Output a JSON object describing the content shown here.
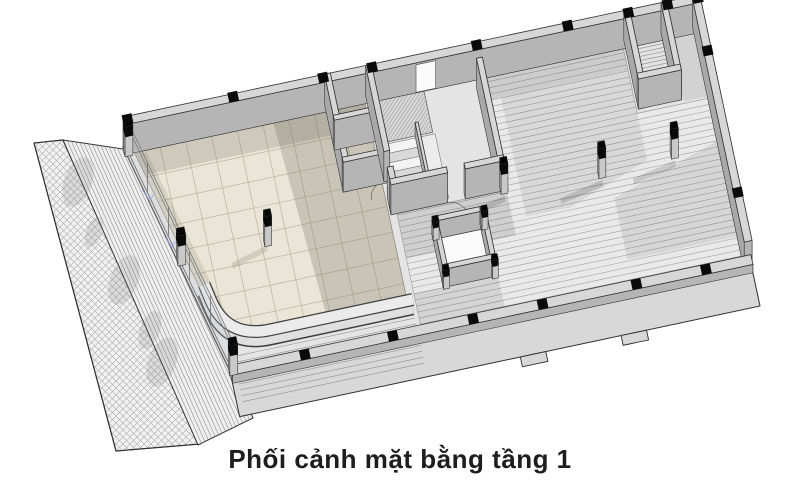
{
  "caption": {
    "text": "Phối cảnh mặt bằng tầng 1",
    "color": "#1d1d1d"
  },
  "colors": {
    "background": "#ffffff",
    "outline": "#2f2f2f",
    "slab": "#e4e4e4",
    "apron": "#d8d8d8",
    "wall_top": "#d7d7d7",
    "wall_face": "#b5b5b5",
    "wall_face_dark": "#a9a9a9",
    "wall_face_light": "#cccccc",
    "column_cap": "#0a0a0a",
    "column_shaft": "#c9c9c9",
    "tile_light": "#eae5d6",
    "tile_line": "#b3ac99",
    "tile_shadow": "#6e6859",
    "hall_base": "#e9e9e9",
    "hall_stripe": "#9b9b9b",
    "stair_light": "#f4f4f4",
    "stair_dark": "#d9d9d9",
    "hatch_line": "#909090",
    "site_line": "#a8a8a8",
    "fence_fill": "#ffffff",
    "glass_line": "#707070",
    "blue_mark": "#8fa3e8",
    "white_floor": "#fbfbfb"
  },
  "view": {
    "origin": [
      123,
      147
    ],
    "rotation": -12,
    "extrusion": [
      6.2,
      -29.3
    ]
  },
  "site": {
    "sidewalk": {
      "points": [
        [
          34,
          143
        ],
        [
          63,
          140
        ],
        [
          200,
          444
        ],
        [
          116,
          451
        ]
      ]
    },
    "ramp_strip": {
      "points": [
        [
          63,
          140
        ],
        [
          130,
          150
        ],
        [
          253,
          418
        ],
        [
          198,
          445
        ]
      ],
      "stripes": 16
    },
    "shadow_blobs": [
      [
        78,
        182,
        14,
        26
      ],
      [
        94,
        232,
        8,
        16
      ],
      [
        124,
        280,
        14,
        26
      ],
      [
        150,
        330,
        10,
        20
      ],
      [
        162,
        362,
        14,
        26
      ]
    ],
    "fence": {
      "main": [
        [
          660,
          4
        ],
        [
          688,
          1
        ],
        [
          748,
          299
        ],
        [
          720,
          311
        ]
      ],
      "notch": [
        [
          650,
          9
        ],
        [
          661,
          7
        ],
        [
          666,
          30
        ],
        [
          655,
          32
        ]
      ]
    }
  },
  "building": {
    "slab_pts": [
      [
        0,
        0
      ],
      [
        590,
        0
      ],
      [
        590,
        250
      ],
      [
        60,
        250
      ]
    ],
    "apron": {
      "x": 58,
      "y": 244,
      "w": 532,
      "h": 44,
      "notches": [
        [
          345,
          288,
          26,
          10
        ],
        [
          448,
          288,
          26,
          10
        ]
      ],
      "step_lines": {
        "x1": 64,
        "x2": 250,
        "ys": [
          228,
          234,
          240,
          256,
          262,
          268,
          274
        ]
      }
    },
    "hall": {
      "poly": [
        [
          368,
          8
        ],
        [
          510,
          8
        ],
        [
          510,
          74
        ],
        [
          582,
          74
        ],
        [
          582,
          242
        ],
        [
          254,
          242
        ],
        [
          254,
          122
        ],
        [
          368,
          122
        ]
      ],
      "stripe_step": 6.2,
      "shadows": [
        {
          "pts": [
            [
              368,
              8
            ],
            [
              510,
              8
            ],
            [
              510,
              30
            ],
            [
              368,
              30
            ]
          ],
          "op": 0.12
        },
        {
          "pts": [
            [
              380,
              30
            ],
            [
              510,
              30
            ],
            [
              510,
              122
            ],
            [
              425,
              152
            ],
            [
              380,
              152
            ]
          ],
          "op": 0.07
        },
        {
          "pts": [
            [
              470,
              152
            ],
            [
              582,
              118
            ],
            [
              582,
              215
            ],
            [
              470,
              215
            ]
          ],
          "op": 0.08
        },
        {
          "pts": [
            [
              254,
              122
            ],
            [
              366,
              122
            ],
            [
              366,
              168
            ],
            [
              254,
              168
            ]
          ],
          "op": 0.11
        },
        {
          "pts": [
            [
              254,
              204
            ],
            [
              340,
              204
            ],
            [
              340,
              242
            ],
            [
              254,
              242
            ]
          ],
          "op": 0.09
        }
      ]
    },
    "corner_zone_shadow": {
      "x": 558,
      "y": 8,
      "w": 24,
      "h": 64,
      "op": 0.08
    },
    "tiles": {
      "path": "M10,8 L246,8 L246,208 L100,208 Q58,208 50,172 Z",
      "grid": 26.3,
      "x1": 10,
      "x2": 246,
      "y1": 8,
      "y2": 208,
      "shadows": [
        {
          "pts": [
            [
              10,
              8
            ],
            [
              246,
              8
            ],
            [
              246,
              32
            ],
            [
              10,
              32
            ]
          ],
          "op": 0.22
        },
        {
          "pts": [
            [
              152,
              8
            ],
            [
              246,
              8
            ],
            [
              246,
              208
            ],
            [
              164,
              208
            ]
          ],
          "op": 0.26
        },
        {
          "pts": [
            [
              6,
              6
            ],
            [
              22,
              10
            ],
            [
              72,
              206
            ],
            [
              56,
              208
            ]
          ],
          "op": 0.16
        },
        {
          "pts": [
            [
              120,
              126
            ],
            [
              82,
              136
            ],
            [
              82,
              142
            ],
            [
              120,
              132
            ]
          ],
          "op": 0.2
        }
      ]
    },
    "top_right_room": {
      "rect": [
        518,
        4,
        32,
        60
      ],
      "stripe_step": 4
    },
    "small_room_floor": {
      "rect": [
        289,
        155,
        44,
        44
      ]
    },
    "ramp_hatch": {
      "pts": [
        [
          254,
          6
        ],
        [
          306,
          6
        ],
        [
          306,
          50
        ],
        [
          254,
          50
        ]
      ],
      "step": 4.2
    },
    "wc": {
      "hatch_rect": [
        208,
        2,
        40,
        40
      ],
      "toilet": [
        226,
        22
      ],
      "sink": [
        227,
        64
      ]
    },
    "stairs": {
      "x": 254,
      "y": 52,
      "w": 36,
      "n": 7,
      "total": 66,
      "landing": [
        290,
        52,
        18,
        66
      ]
    },
    "planter": {
      "base": "M250,218 L104,218 Q60,218 52,176 L49,160"
    },
    "glass": {
      "a": [
        3,
        2
      ],
      "b": [
        60,
        240
      ],
      "mullions": 5,
      "blue_marks": [
        "M10,46 l5,12 l5,-5",
        "M22,96 l5,12 l5,-5"
      ]
    },
    "door_arcs": [
      "M248,88 A16,16 0 0 0 232,104",
      "M306,122 A18,18 0 0 1 324,140"
    ],
    "door_gap_north": {
      "x1": 298,
      "x2": 318,
      "y": 7.5,
      "hf": 0.92
    },
    "walls": [
      {
        "name": "north-wall",
        "x": 0,
        "y": 0,
        "w": 590,
        "d": 8,
        "h": 1
      },
      {
        "name": "wc-west-wall",
        "x": 206,
        "y": 0,
        "w": 6,
        "d": 90,
        "h": 1
      },
      {
        "name": "wc-divider-wall",
        "x": 206,
        "y": 42,
        "w": 44,
        "d": 5,
        "h": 1
      },
      {
        "name": "wc-south-wall",
        "x": 206,
        "y": 85,
        "w": 44,
        "d": 5,
        "h": 1
      },
      {
        "name": "core-west-wall-a",
        "x": 248,
        "y": 0,
        "w": 6,
        "d": 88,
        "h": 1
      },
      {
        "name": "core-west-wall-b",
        "x": 248,
        "y": 104,
        "w": 6,
        "d": 18,
        "h": 1
      },
      {
        "name": "stair-divider",
        "x": 288,
        "y": 50,
        "w": 3,
        "d": 68,
        "h": 0.45
      },
      {
        "name": "core-east-wall",
        "x": 358,
        "y": 16,
        "w": 6,
        "d": 106,
        "h": 1
      },
      {
        "name": "core-south-wall-a",
        "x": 248,
        "y": 116,
        "w": 58,
        "d": 6,
        "h": 1
      },
      {
        "name": "core-south-wall-b",
        "x": 324,
        "y": 116,
        "w": 40,
        "d": 6,
        "h": 1
      },
      {
        "name": "ramp-room-west-wall",
        "x": 512,
        "y": 0,
        "w": 6,
        "d": 70,
        "h": 1
      },
      {
        "name": "ramp-room-east-wall",
        "x": 550,
        "y": 0,
        "w": 6,
        "d": 70,
        "h": 1
      },
      {
        "name": "ramp-room-south-wall",
        "x": 512,
        "y": 64,
        "w": 44,
        "d": 6,
        "h": 1
      },
      {
        "name": "east-boundary-wall",
        "x": 582,
        "y": 0,
        "w": 8,
        "d": 250,
        "h": 0.95
      },
      {
        "name": "small-room-north-wall",
        "x": 284,
        "y": 150,
        "w": 54,
        "d": 5,
        "h": 0.6
      },
      {
        "name": "small-room-west-wall",
        "x": 284,
        "y": 150,
        "w": 5,
        "d": 54,
        "h": 0.6
      },
      {
        "name": "small-room-east-wall",
        "x": 333,
        "y": 150,
        "w": 5,
        "d": 54,
        "h": 0.6
      },
      {
        "name": "small-room-south-wall",
        "x": 284,
        "y": 199,
        "w": 54,
        "d": 5,
        "h": 0.6
      },
      {
        "name": "front-low-wall",
        "x": 58,
        "y": 244,
        "w": 532,
        "d": 10,
        "h": 0.28
      }
    ],
    "columns": {
      "free": [
        {
          "p": [
            0,
            2
          ],
          "s": 8,
          "h": 1
        },
        {
          "p": [
            29,
            120
          ],
          "s": 8,
          "h": 1
        },
        {
          "p": [
            57,
            238
          ],
          "s": 8,
          "h": 1
        },
        {
          "p": [
            118,
            120
          ],
          "s": 7,
          "h": 1
        },
        {
          "p": [
            360,
            118
          ],
          "s": 7,
          "h": 1
        },
        {
          "p": [
            459,
            123
          ],
          "s": 7,
          "h": 1
        },
        {
          "p": [
            534,
            119
          ],
          "s": 7,
          "h": 1
        },
        {
          "p": [
            284,
            150
          ],
          "s": 6,
          "h": 0.62
        },
        {
          "p": [
            334,
            150
          ],
          "s": 6,
          "h": 0.62
        },
        {
          "p": [
            284,
            200
          ],
          "s": 6,
          "h": 0.62
        },
        {
          "p": [
            334,
            200
          ],
          "s": 6,
          "h": 0.62
        }
      ],
      "caps_top_wall_x": [
        0,
        108,
        200,
        250,
        357,
        450,
        512,
        552,
        583
      ],
      "caps_bottom_wall_x": [
        128,
        218,
        300,
        371,
        467,
        538
      ],
      "caps_right_wall_y": [
        50,
        195
      ],
      "shadow_cols": [
        [
          360,
          118
        ],
        [
          459,
          123
        ],
        [
          534,
          119
        ]
      ]
    }
  }
}
